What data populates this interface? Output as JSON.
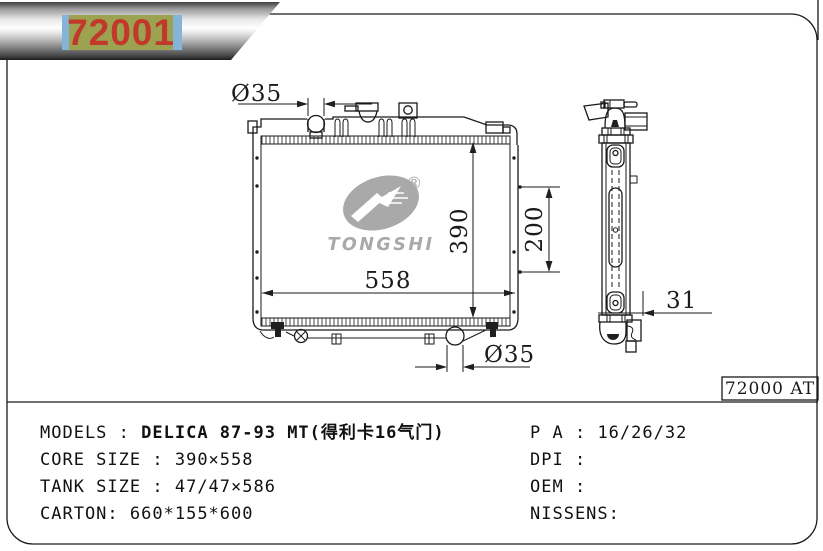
{
  "banner": {
    "part_number": "72001"
  },
  "drawing": {
    "dims": {
      "top_inlet_diameter": "Ø35",
      "bottom_outlet_diameter": "Ø35",
      "core_height": "390",
      "bracket_span": "200",
      "core_width": "558",
      "side_depth": "31"
    },
    "logo": {
      "brand": "TONGSHI",
      "registered_mark": "®"
    },
    "ref_code": "72000 AT"
  },
  "specs": {
    "left": [
      {
        "label": "MODELS",
        "separator": " : ",
        "value": "DELICA 87-93 MT(得利卡16气门)"
      },
      {
        "label": "CORE SIZE",
        "separator": " : ",
        "value": "390×558"
      },
      {
        "label": "TANK SIZE",
        "separator": " : ",
        "value": "47/47×586"
      },
      {
        "label": "CARTON",
        "separator": ": ",
        "value": "660*155*600"
      }
    ],
    "right": [
      {
        "label": "P A",
        "separator": " : ",
        "value": "16/26/32"
      },
      {
        "label": "DPI",
        "separator": " : ",
        "value": ""
      },
      {
        "label": "OEM",
        "separator": " : ",
        "value": ""
      },
      {
        "label": "NISSENS",
        "separator": ":",
        "value": ""
      }
    ]
  },
  "colors": {
    "banner_label_bg": "#9ca24f",
    "banner_label_edge": "#85b4d8",
    "part_number_red": "#c0392b",
    "line_ink": "#1a1a1a",
    "logo_gray": "#a9a9a9"
  }
}
